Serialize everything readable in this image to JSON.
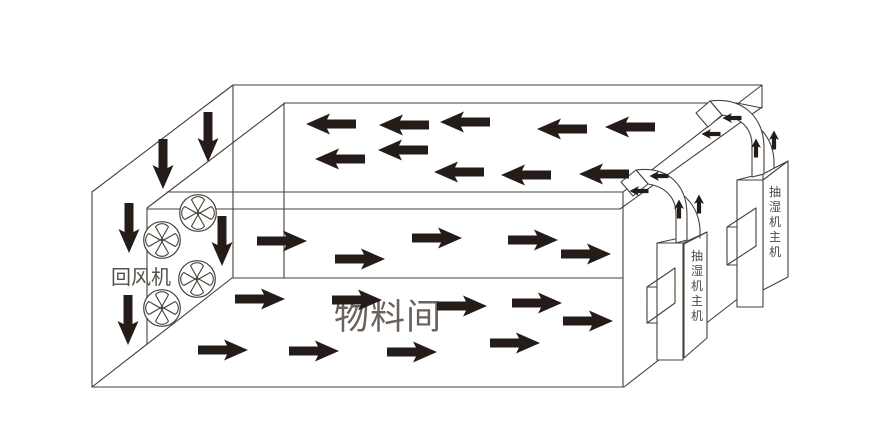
{
  "labels": {
    "material_room": "物料间",
    "return_fan": "回风机",
    "dehumidifier_unit": "抽湿机主机"
  },
  "colors": {
    "background": "#ffffff",
    "line": "#46403a",
    "arrow": "#241c18",
    "text_large": "#6a625b",
    "text_small": "#4c4742"
  },
  "airflow": {
    "ceiling_left": [
      [
        331,
        124
      ],
      [
        404,
        125
      ],
      [
        465,
        122
      ],
      [
        562,
        129
      ],
      [
        630,
        127
      ],
      [
        340,
        159
      ],
      [
        403,
        150
      ],
      [
        459,
        172
      ],
      [
        526,
        175
      ],
      [
        604,
        174
      ]
    ],
    "plenum_right": [
      [
        282,
        241
      ],
      [
        360,
        259
      ],
      [
        437,
        238
      ],
      [
        533,
        240
      ],
      [
        586,
        254
      ]
    ],
    "room_right": [
      [
        260,
        299
      ],
      [
        357,
        300
      ],
      [
        462,
        306
      ],
      [
        537,
        303
      ],
      [
        588,
        321
      ],
      [
        223,
        350
      ],
      [
        314,
        351
      ],
      [
        412,
        352
      ],
      [
        515,
        343
      ]
    ],
    "wall_down": [
      [
        163,
        164
      ],
      [
        208,
        137
      ],
      [
        129,
        228
      ],
      [
        222,
        241
      ],
      [
        128,
        320
      ]
    ],
    "duct_left_small": [
      [
        732,
        118
      ],
      [
        711,
        134
      ],
      [
        659,
        176
      ],
      [
        639,
        191
      ]
    ],
    "duct_up_small": [
      [
        756,
        148
      ],
      [
        774,
        140
      ],
      [
        679,
        209
      ],
      [
        699,
        204
      ]
    ]
  },
  "fans": [
    [
      198,
      213
    ],
    [
      162,
      240
    ],
    [
      197,
      279
    ],
    [
      162,
      308
    ]
  ]
}
